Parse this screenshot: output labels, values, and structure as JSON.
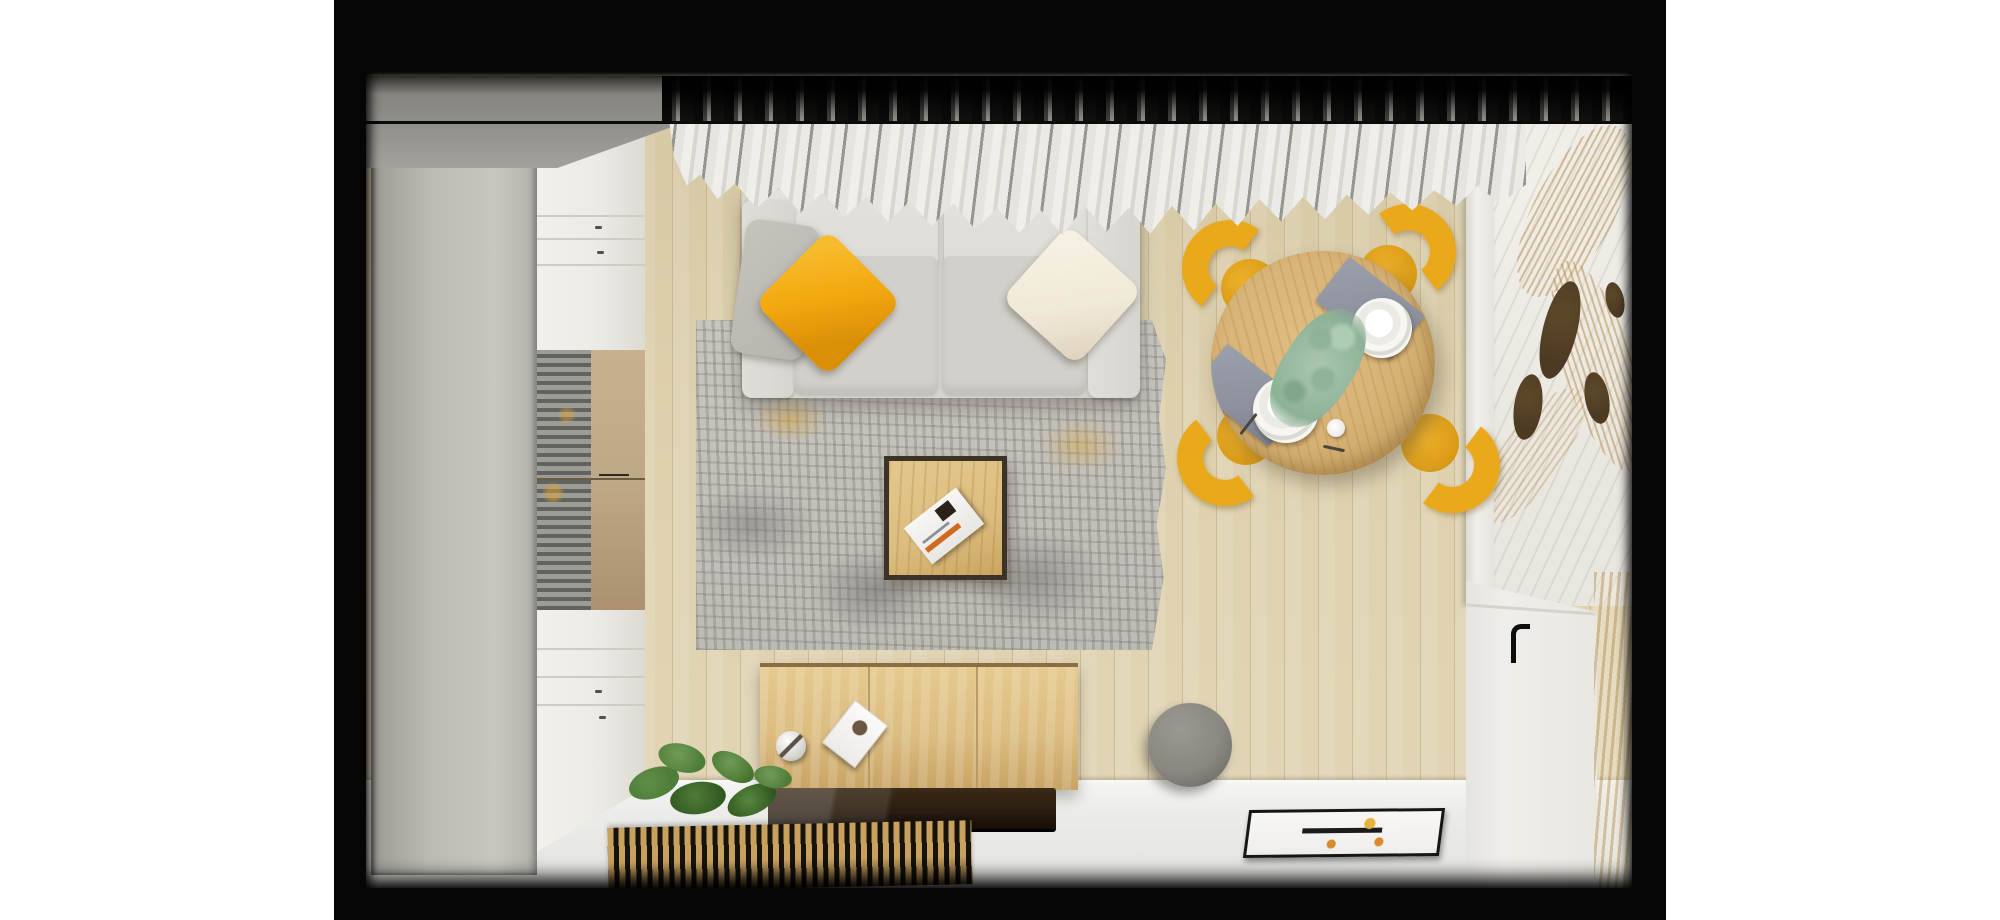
{
  "scene": {
    "type": "interior-render-top-view",
    "objects": [
      "wardrobe",
      "display-cabinet",
      "curtains",
      "sofa",
      "yellow-pillow",
      "gray-pillow",
      "cream-pillow",
      "area-rug",
      "coffee-table",
      "magazine",
      "dining-table",
      "dining-chairs",
      "placemats",
      "plates",
      "eucalyptus-centerpiece",
      "cup",
      "sideboard",
      "tv-panel",
      "decor-sphere",
      "decor-card",
      "slatted-bench",
      "plant",
      "ball-pouf",
      "floor-art-frame",
      "marble-wall",
      "palm-leaves",
      "wall-ovals",
      "white-door",
      "door-handle",
      "wood-floor",
      "white-floor"
    ]
  },
  "palette": {
    "page_bg": "#ffffff",
    "mat": "#050505",
    "ceiling": "#96948f",
    "wall_wood": "#ddd0ad",
    "plank_line": "#b7a276",
    "wardrobe_top": "#bdbab4",
    "wardrobe_edge": "#8e8b85",
    "cabinet_white": "#edebe6",
    "cabinet_seam": "#cfccc5",
    "glass_gray": "#8f8f8c",
    "glass_bronze": "#bfa887",
    "curtain_light": "#efeeea",
    "curtain_mid": "#c7c5c0",
    "curtain_dark": "#97958f",
    "sofa": "#d7d5cf",
    "sofa_cushion": "#dedcd7",
    "sofa_seat": "#d2d0ca",
    "pillow_yellow": "#f3a90f",
    "pillow_yellow_deep": "#d98f06",
    "pillow_gray": "#b7b4ae",
    "pillow_cream": "#f0e9d8",
    "rug_base": "#c8c5bf",
    "rug_dark": "#8b8984",
    "rug_yellow": "#dfa42e",
    "table_wood": "#d7b174",
    "table_wood_deep": "#c09a58",
    "chair_yellow": "#eaa81b",
    "chair_yellow_deep": "#cf8f10",
    "placemat": "#8d919d",
    "plate": "#f6f5f2",
    "eucalyptus": "#abc7b0",
    "eucalyptus_deep": "#8db296",
    "coffee_frame": "#3b3228",
    "coffee_wood": "#dcbd7f",
    "sideboard_wood": "#dcbd80",
    "sideboard_edge": "#8a6f45",
    "tv_panel": "#291c10",
    "slat_wood": "#c9a15f",
    "slat_gap": "#16120c",
    "plant_green": "#4e7c39",
    "plant_dark": "#30571f",
    "plant_light": "#6f9c55",
    "pouf": "#8a8781",
    "white_floor": "#ebebe9",
    "marble": "#e9e6e0",
    "palm": "#d3bc92",
    "oval_brown": "#4d3a23",
    "door_white": "#f0eeea",
    "handle_black": "#0d0d0d",
    "magazine_orange": "#d06a1e",
    "art_black": "#1c1c1c",
    "art_orange": "#d98a2b",
    "art_yellow": "#e4b43c"
  }
}
